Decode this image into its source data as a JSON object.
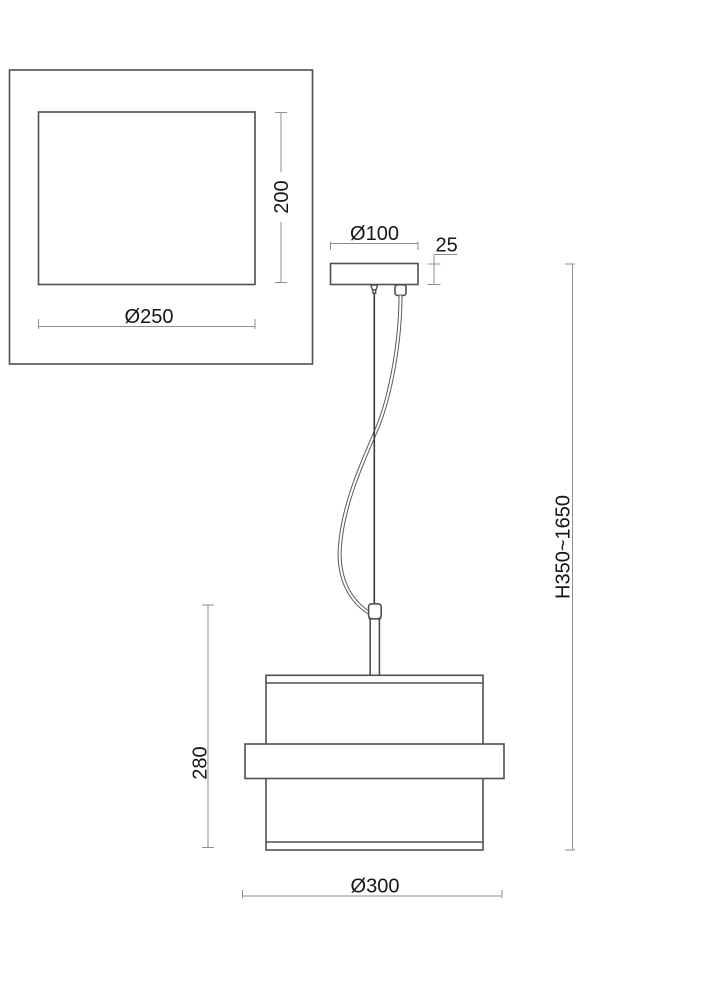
{
  "drawing": {
    "kind": "pendant-lamp-dimension-drawing",
    "top_view": {
      "height_label": "200",
      "diameter_label": "Ø250"
    },
    "canopy": {
      "diameter_label": "Ø100",
      "height_label": "25"
    },
    "shade": {
      "height_label": "280",
      "diameter_label": "Ø300"
    },
    "suspension": {
      "height_range_label": "H350~1650"
    }
  },
  "colors": {
    "background": "#ffffff",
    "object_line": "#4f4f4f",
    "dimension_line": "#8f8f8f",
    "cable_line": "#5a5a5a",
    "wire_line": "#383838",
    "label_text": "#161616"
  }
}
